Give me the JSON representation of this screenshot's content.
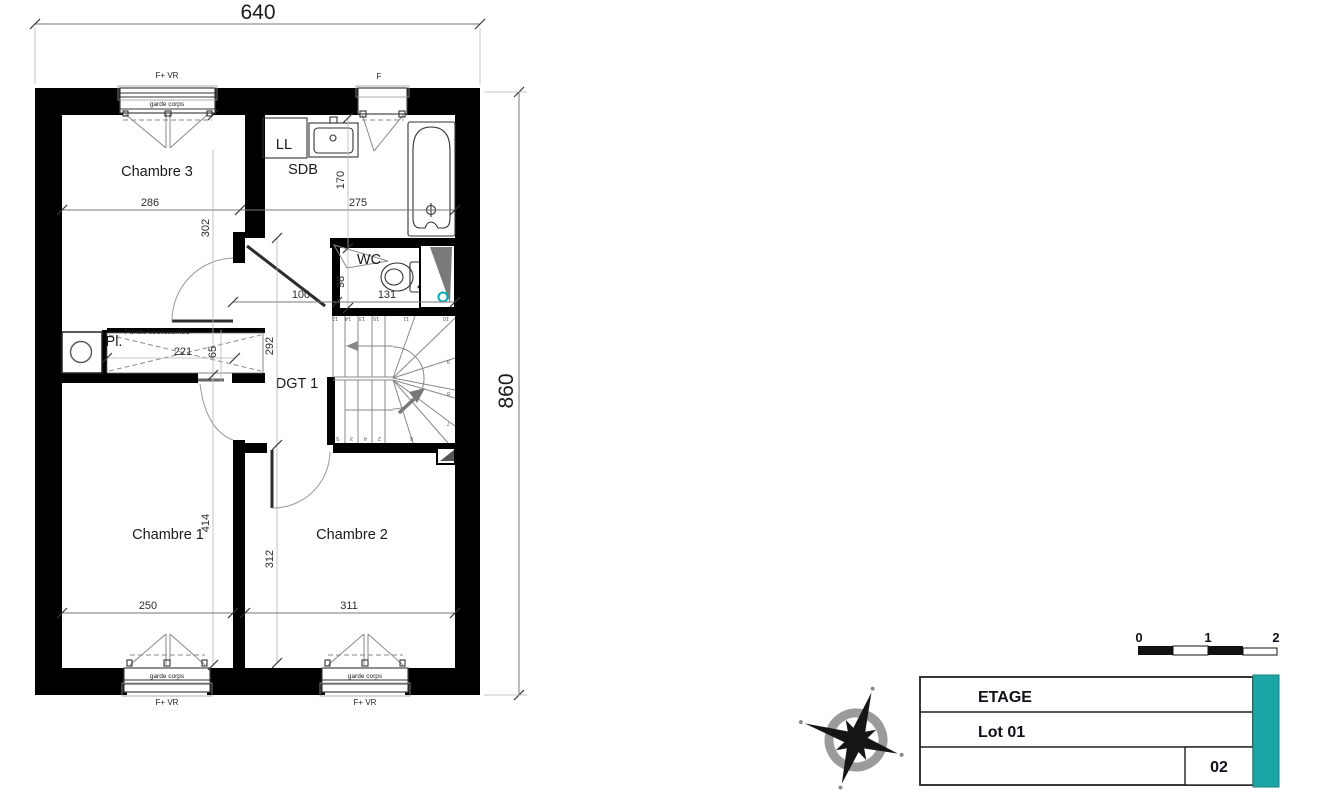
{
  "drawing": {
    "overall": {
      "width": "640",
      "height": "860"
    },
    "rooms": {
      "ch3": "Chambre 3",
      "sdb": "SDB",
      "wc": "WC",
      "dgt": "DGT 1",
      "pl": "Pl.",
      "ch1": "Chambre 1",
      "ch2": "Chambre 2"
    },
    "fixtures": {
      "washer": "LL"
    },
    "annotations": {
      "sliding_doors": "Portes coulissantes",
      "guardrail": "garde corps",
      "window_vr": "F+ VR",
      "window_f": "F"
    },
    "dims": {
      "ch3_w": "286",
      "ch3_h": "302",
      "sdb_w": "275",
      "sdb_h": "170",
      "hall_w": "100",
      "wc_h": "98",
      "wc_w": "131",
      "dgt_h": "292",
      "pl_w": "221",
      "pl_d": "65",
      "ch1_h": "414",
      "ch1_w": "250",
      "ch2_h": "312",
      "ch2_w": "311"
    },
    "stairs": {
      "top": [
        "12",
        "14",
        "13",
        "15",
        "11",
        "10"
      ],
      "right": [
        "9",
        "8",
        "7"
      ],
      "bottom": [
        "5",
        "3",
        "4",
        "2",
        "6"
      ]
    }
  },
  "scale_bar": {
    "labels": [
      "0",
      "1",
      "2"
    ]
  },
  "title_block": {
    "row1": "ETAGE",
    "row2": "Lot 01",
    "sheet_number": "02",
    "accent_color": "#1ba5a5"
  }
}
